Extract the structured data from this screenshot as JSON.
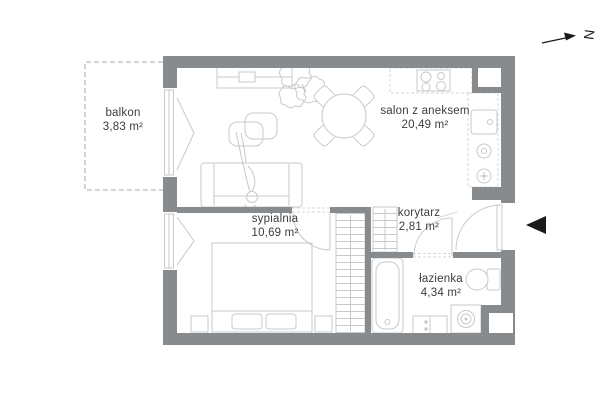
{
  "meta": {
    "type": "apartment-floor-plan",
    "language": "pl"
  },
  "colors": {
    "wall": "#878b8e",
    "furniture_line": "#c6cacc",
    "dashed_line": "#d6d8d9",
    "text": "#3a3d3f",
    "marker": "#1b1b1b",
    "background": "#ffffff"
  },
  "compass": {
    "label": "N"
  },
  "rooms": [
    {
      "id": "balkon",
      "name": "balkon",
      "area": "3,83 m²"
    },
    {
      "id": "salon",
      "name": "salon z aneksem",
      "area": "20,49 m²"
    },
    {
      "id": "sypialnia",
      "name": "sypialnia",
      "area": "10,69 m²"
    },
    {
      "id": "korytarz",
      "name": "korytarz",
      "area": "2,81 m²"
    },
    {
      "id": "lazienka",
      "name": "łazienka",
      "area": "4,34 m²"
    }
  ],
  "fixtures": [
    "tv-console",
    "tv",
    "plant",
    "coffee-tables",
    "sofa",
    "person",
    "dining-table",
    "dining-chair",
    "kitchen-counter",
    "cooktop",
    "kitchen-sink",
    "counter-burner",
    "shaft",
    "bed",
    "pillow",
    "nightstand",
    "wardrobe",
    "hall-wardrobe",
    "bathtub",
    "bathroom-cabinet",
    "washing-machine",
    "toilet",
    "window",
    "door-swing",
    "entrance-door",
    "entrance-arrow",
    "north-arrow"
  ]
}
